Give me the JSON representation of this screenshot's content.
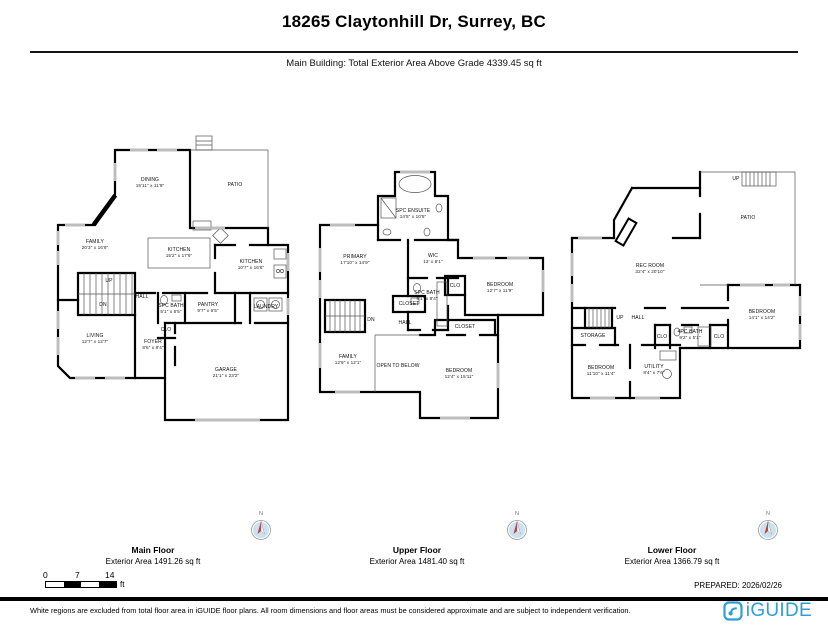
{
  "header": {
    "title": "18265 Claytonhill Dr, Surrey, BC",
    "subtitle": "Main Building: Total Exterior Area Above Grade 4339.45 sq ft"
  },
  "floors": [
    {
      "id": "main",
      "title": "Main Floor",
      "area": "Exterior Area 1491.26 sq ft",
      "rooms": [
        {
          "name": "DINING",
          "dims": "15'11\" x 11'9\"",
          "x": 105,
          "y": 50
        },
        {
          "name": "PATIO",
          "x": 190,
          "y": 52
        },
        {
          "name": "FAMILY",
          "dims": "20'3\" x 16'9\"",
          "x": 50,
          "y": 112
        },
        {
          "name": "KITCHEN",
          "dims": "15'2\" x 17'6\"",
          "x": 134,
          "y": 120
        },
        {
          "name": "KITCHEN",
          "dims": "10'7\" x 16'6\"",
          "x": 206,
          "y": 132
        },
        {
          "name": "UP",
          "x": 64,
          "y": 148
        },
        {
          "name": "DN",
          "x": 58,
          "y": 172
        },
        {
          "name": "HALL",
          "x": 97,
          "y": 164
        },
        {
          "name": "SPC BATH",
          "dims": "5'1\" x 6'5\"",
          "x": 126,
          "y": 176
        },
        {
          "name": "PANTRY",
          "dims": "9'7\" x 6'5\"",
          "x": 163,
          "y": 175
        },
        {
          "name": "LAUNDRY",
          "x": 221,
          "y": 174
        },
        {
          "name": "CLO",
          "x": 121,
          "y": 197
        },
        {
          "name": "FOYER",
          "dims": "8'6\" x 8'4\"",
          "x": 108,
          "y": 212
        },
        {
          "name": "LIVING",
          "dims": "12'7\" x 12'7\"",
          "x": 50,
          "y": 206
        },
        {
          "name": "GARAGE",
          "dims": "21'1\" x 23'2\"",
          "x": 181,
          "y": 240
        }
      ]
    },
    {
      "id": "upper",
      "title": "Upper Floor",
      "area": "Exterior Area 1481.40 sq ft",
      "rooms": [
        {
          "name": "SPC ENSUITE",
          "dims": "14'5\" x 10'5\"",
          "x": 98,
          "y": 46
        },
        {
          "name": "PRIMARY",
          "dims": "17'10\" x 14'9\"",
          "x": 40,
          "y": 92
        },
        {
          "name": "WIC",
          "dims": "13' x 9'1\"",
          "x": 118,
          "y": 91
        },
        {
          "name": "CLO",
          "x": 140,
          "y": 118
        },
        {
          "name": "BEDROOM",
          "dims": "12'7\" x 11'9\"",
          "x": 185,
          "y": 120
        },
        {
          "name": "SPC BATH",
          "dims": "9'1\" x 8'4\"",
          "x": 112,
          "y": 128
        },
        {
          "name": "CLOSET",
          "x": 94,
          "y": 136
        },
        {
          "name": "DN",
          "x": 56,
          "y": 152
        },
        {
          "name": "HALL",
          "x": 90,
          "y": 155
        },
        {
          "name": "FAMILY",
          "dims": "12'9\" x 12'1\"",
          "x": 33,
          "y": 192
        },
        {
          "name": "OPEN TO BELOW",
          "x": 83,
          "y": 198
        },
        {
          "name": "CLOSET",
          "x": 150,
          "y": 159
        },
        {
          "name": "BEDROOM",
          "dims": "12'4\" x 15'11\"",
          "x": 144,
          "y": 206
        }
      ]
    },
    {
      "id": "lower",
      "title": "Lower Floor",
      "area": "Exterior Area 1366.79 sq ft",
      "rooms": [
        {
          "name": "UP",
          "x": 166,
          "y": 11
        },
        {
          "name": "PATIO",
          "x": 178,
          "y": 50
        },
        {
          "name": "REC ROOM",
          "dims": "32'4\" x 20'10\"",
          "x": 80,
          "y": 101
        },
        {
          "name": "BEDROOM",
          "dims": "14'1\" x 14'2\"",
          "x": 192,
          "y": 147
        },
        {
          "name": "UP",
          "x": 50,
          "y": 150
        },
        {
          "name": "STORAGE",
          "x": 23,
          "y": 168
        },
        {
          "name": "HALL",
          "x": 68,
          "y": 150
        },
        {
          "name": "CLO",
          "x": 92,
          "y": 169
        },
        {
          "name": "4PC BATH",
          "dims": "9'2\" x 5'1\"",
          "x": 120,
          "y": 167
        },
        {
          "name": "CLO",
          "x": 149,
          "y": 169
        },
        {
          "name": "BEDROOM",
          "dims": "11'10\" x 11'4\"",
          "x": 31,
          "y": 203
        },
        {
          "name": "UTILITY",
          "dims": "8'4\" x 7'6\"",
          "x": 84,
          "y": 202
        }
      ]
    }
  ],
  "compass": {
    "north_label": "N"
  },
  "scale_bar": {
    "ticks": [
      "0",
      "7",
      "14"
    ],
    "unit": "ft"
  },
  "prepared_label": "PREPARED: 2026/02/26",
  "footer": {
    "disclaimer": "White regions are excluded from total floor area in iGUIDE floor plans. All room dimensions and floor areas must be considered approximate and are subject to independent verification.",
    "logo_text": "iGUIDE",
    "logo_color": "#2E9FDA"
  }
}
